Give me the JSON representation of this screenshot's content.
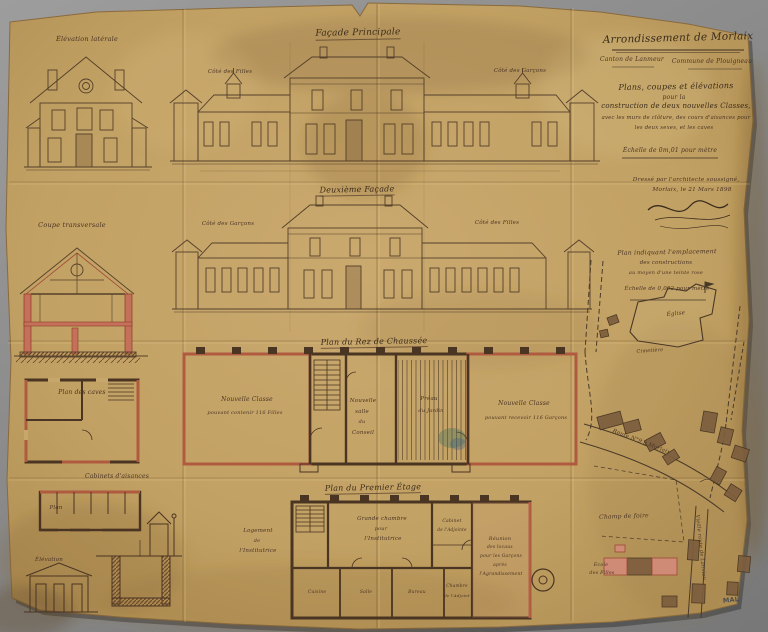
{
  "colors": {
    "paper": "#c2a164",
    "ink": "#54402a",
    "wall_dark": "#42301d",
    "new_work_pink": "#c4705a",
    "section_red": "#a84a32",
    "building_brown": "#7d5e3e",
    "background_gray": "#8a8a8a"
  },
  "titleblock": {
    "arrondissement": "Arrondissement de Morlaix",
    "canton": "Canton de Lanmeur",
    "commune": "Commune de Plouigneau",
    "object1": "Plans, coupes et élévations",
    "object2": "pour la",
    "object3": "construction de deux nouvelles Classes,",
    "object4": "avec les murs de clôture, des cours d'aisances pour",
    "object5": "les deux sexes, et les caves",
    "scale": "Échelle de 0m,01 pour mètre",
    "signed1": "Dressé par l'architecte soussigné,",
    "signed2": "Morlaix, le 21 Mars 1898"
  },
  "drawings": {
    "elevation_laterale": "Élévation latérale",
    "coupe_transversale": "Coupe transversale",
    "plan_caves": "Plan des caves",
    "facade_principale": "Façade Principale",
    "fp_left": "Côté des Filles",
    "fp_right": "Côté des Garçons",
    "facade_2": "Deuxième Façade",
    "f2_left": "Côté des Garçons",
    "f2_right": "Côté des Filles"
  },
  "rdc": {
    "title": "Plan du Rez de Chaussée",
    "left1": "Nouvelle Classe",
    "left2": "pouvant contenir 116 Filles",
    "conseil1": "Nouvelle",
    "conseil2": "salle",
    "conseil3": "du",
    "conseil4": "Conseil",
    "preau1": "Préau",
    "preau2": "du Jardin",
    "right1": "Nouvelle Classe",
    "right2": "pouvant recevoir 116 Garçons"
  },
  "etage": {
    "title": "Plan du Premier Étage",
    "note1": "Logement",
    "note2": "de",
    "note3": "l'Institutrice",
    "chambre1": "Grande chambre",
    "chambre2": "pour",
    "chambre3": "l'Institutrice",
    "cabinet1": "Cabinet",
    "cabinet2": "de l'Adjointe",
    "right1": "Réunion",
    "right2": "des locaux",
    "right3": "pour les Garçons",
    "right4": "après",
    "right5": "l'Agrandissement",
    "room1": "Cuisine",
    "room2": "Salle",
    "room3": "Bureau",
    "room4": "Chambre",
    "room4b": "de l'Adjoint"
  },
  "aisances": {
    "title": "Cabinets d'aisances",
    "plan": "Plan",
    "elevation": "Élévation"
  },
  "siteplan": {
    "h1": "Plan indiquant l'emplacement",
    "h2": "des constructions",
    "h3": "au moyen d'une teinte rose",
    "h4": "Échelle de 0,002 pour mètre",
    "eglise": "Église",
    "cimetiere": "Cimetière",
    "route": "Route N°9 à Morlaix",
    "champ": "Champ de foire",
    "ecole1": "École",
    "ecole2": "des Filles",
    "vieille": "Vieille route de Lannion",
    "stamp": "MAL"
  }
}
